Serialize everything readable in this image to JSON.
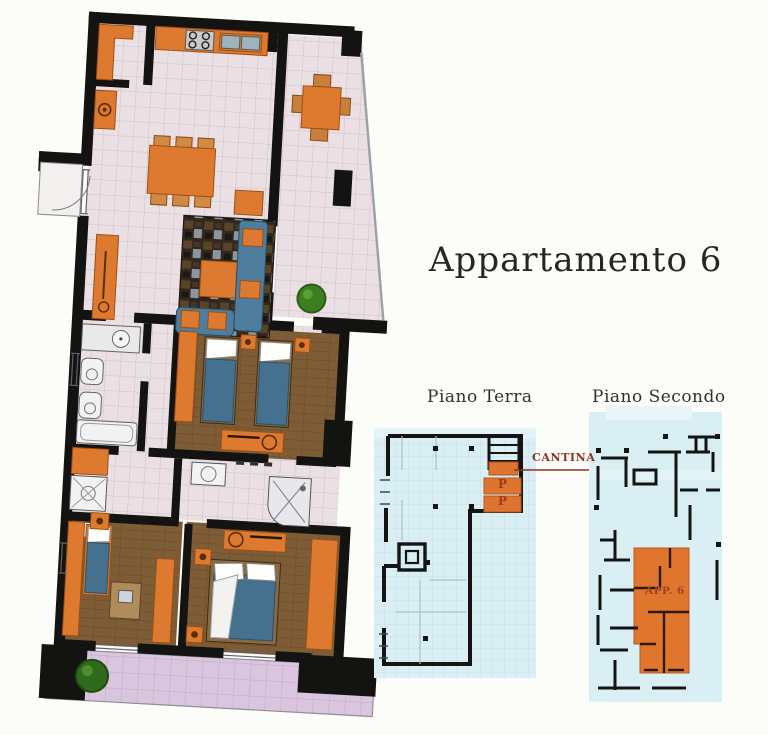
{
  "title": {
    "text": "Appartamento 6"
  },
  "labels": {
    "piano_terra": "Piano Terra",
    "piano_secondo": "Piano Secondo"
  },
  "piano_terra": {
    "cantina_label": "CANTINA",
    "parking": [
      "P",
      "P"
    ]
  },
  "piano_secondo": {
    "apartment_label": "APP. 6"
  },
  "main_plan": {
    "rooms": [
      "kitchen",
      "utility-room",
      "living-dining-room",
      "terrace",
      "bathroom-1",
      "hallway",
      "twin-bedroom",
      "bathroom-2",
      "laundry-shower",
      "bedroom-left",
      "bedroom-right",
      "balcony-strip"
    ],
    "furniture": [
      "kitchen-counter",
      "stove",
      "sink",
      "dining-table-with-chairs",
      "sideboard",
      "rug",
      "coffee-table",
      "sofa",
      "loveseat",
      "armchair",
      "terrace-table-with-chairs",
      "plants",
      "bathtub",
      "toilet",
      "bidet",
      "washbasin",
      "shower",
      "twin-beds",
      "dresser",
      "wardrobes",
      "single-bed",
      "desk",
      "double-bed",
      "nightstands"
    ]
  },
  "colors": {
    "wall": "#131311",
    "furniture_orange": "#dd7a30",
    "bed_blue": "#4f7d9d",
    "floor_brown": "#7d5c36",
    "tile_pink": "#eae0e4",
    "tile_lavender": "#d9c6de",
    "keyplan_cyan": "#daeff3",
    "plant_green": "#3e7d22",
    "annotation_red": "#8e3322"
  }
}
